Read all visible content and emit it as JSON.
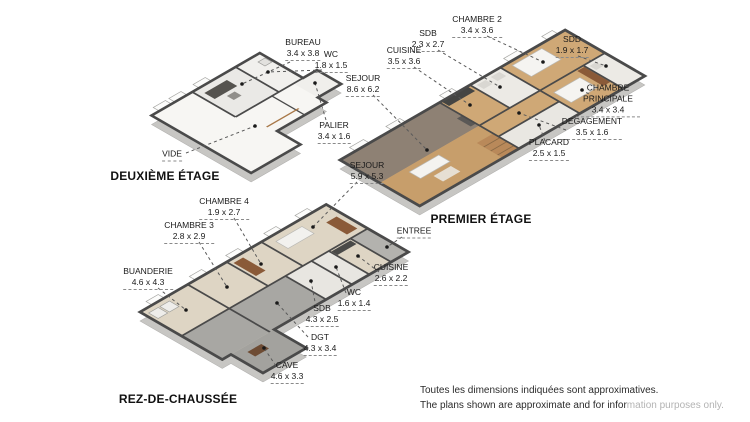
{
  "figure": {
    "type": "3d-floorplan-set",
    "floor_count": 3
  },
  "floors": {
    "deuxieme": {
      "title": "DEUXIÈME ÉTAGE",
      "rooms": [
        {
          "name": "BUREAU",
          "dims": "3.4 x 3.8"
        },
        {
          "name": "WC",
          "dims": "1.8 x 1.5"
        },
        {
          "name": "PALIER",
          "dims": "3.4 x 1.6"
        },
        {
          "name": "VIDE",
          "dims": ""
        }
      ]
    },
    "premier": {
      "title": "PREMIER ÉTAGE",
      "rooms": [
        {
          "name": "CHAMBRE 2",
          "dims": "3.4 x 3.6"
        },
        {
          "name": "SDB",
          "dims": "2.3 x 2.7"
        },
        {
          "name": "CUISINE",
          "dims": "3.5 x 3.6"
        },
        {
          "name": "SEJOUR",
          "dims": "8.6 x 6.2"
        },
        {
          "name": "SDD",
          "dims": "1.9 x 1.7"
        },
        {
          "name": "CHAMBRE PRINCIPALE",
          "dims": "3.4 x 3.4"
        },
        {
          "name": "DEGAGEMENT",
          "dims": "3.5 x 1.6"
        },
        {
          "name": "PLACARD",
          "dims": "2.5 x 1.5"
        }
      ]
    },
    "rdc": {
      "title": "REZ-DE-CHAUSSÉE",
      "rooms": [
        {
          "name": "SEJOUR",
          "dims": "5.9 x 5.3"
        },
        {
          "name": "CHAMBRE 4",
          "dims": "1.9 x 2.7"
        },
        {
          "name": "CHAMBRE 3",
          "dims": "2.8 x 2.9"
        },
        {
          "name": "BUANDERIE",
          "dims": "4.6 x 4.3"
        },
        {
          "name": "ENTREE",
          "dims": ""
        },
        {
          "name": "CUISINE",
          "dims": "2.6 x 2.2"
        },
        {
          "name": "WC",
          "dims": "1.6 x 1.4"
        },
        {
          "name": "SDB",
          "dims": "4.3 x 2.5"
        },
        {
          "name": "DGT",
          "dims": "4.3 x 3.4"
        },
        {
          "name": "CAVE",
          "dims": "4.6 x 3.3"
        }
      ]
    }
  },
  "disclaimer": {
    "line1": "Toutes les dimensions indiquées sont approximatives.",
    "line2_dark": "The plans shown are approximate and for infor",
    "line2_faded": "mation purposes only."
  },
  "colors": {
    "wood_floor": "#c9a06e",
    "carpet": "#8e8174",
    "tile": "#eceae5",
    "beige_floor": "#ded5c4",
    "concrete": "#a8a7a3",
    "wall_line": "#4a4a4a",
    "slab": "#c7c6c3",
    "wood_furniture": "#8a5a38",
    "label_text": "#1a1a1a",
    "leader_line": "#5a5a5a"
  }
}
